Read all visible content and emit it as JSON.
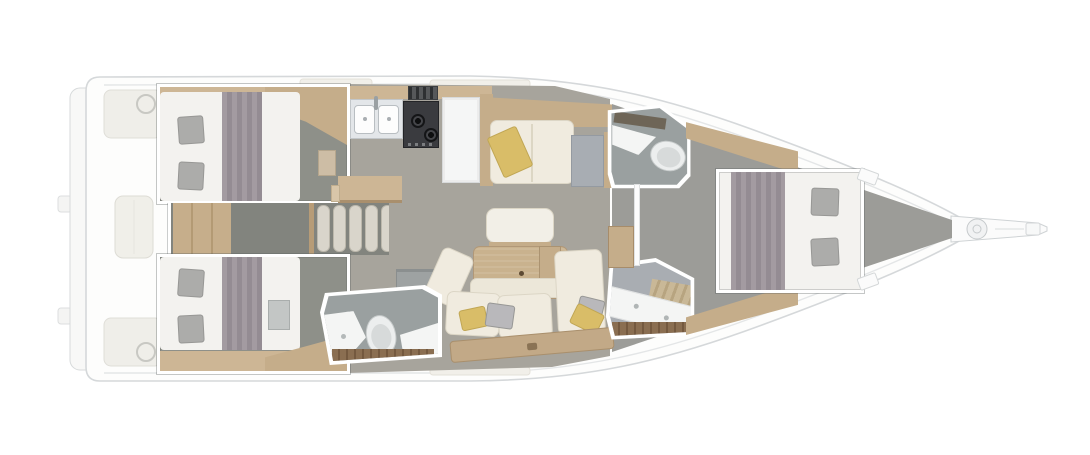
{
  "scene": {
    "type": "yacht-interior-floorplan",
    "orientation": "bow-right",
    "rooms": [
      "swim-platform",
      "aft-cockpit",
      "starboard-aft-cabin",
      "port-aft-cabin",
      "companionway-stairs",
      "galley",
      "salon",
      "starboard-head",
      "port-head",
      "forward-shower",
      "forward-cabin",
      "bowsprit"
    ],
    "furniture": [
      "double-bed-starboard-aft",
      "double-bed-port-aft",
      "double-bed-forward",
      "galley-sink",
      "galley-stove",
      "galley-oven",
      "refrigerator",
      "dining-table",
      "u-shaped-sofa",
      "white-bench",
      "starboard-settee",
      "nav-table",
      "toilet-x2",
      "shower-counter",
      "helm-wheel-x2",
      "cockpit-table",
      "anchor-windlass"
    ]
  },
  "palette": {
    "hull_line": "#d5d8da",
    "deck_white": "#fdfdfc",
    "cockpit_fill": "#efeee9",
    "floor_salon": "#a7a49c",
    "floor_cabin": "#8e9089",
    "floor_forward": "#9c9c98",
    "floor_head": "#9aa0a0",
    "floor_corridor": "#82847e",
    "wood_light": "#cdb695",
    "wood_mid": "#c5ad8a",
    "wood_dark": "#8a6e51",
    "bed_white": "#f3f2ef",
    "blanket_gray": "#9a929a",
    "pillow_gray": "#acacaa",
    "cushion_cream": "#f0ebdf",
    "pillow_yellow": "#d9bd68",
    "table_wood": "#c9b28e",
    "stairs_tread": "#d9d5cb",
    "appliance_dark": "#3a3b3f",
    "fixture_white": "#f4f5f4",
    "nav_gray": "#a8adb3",
    "panel_blue_gray": "#a9adb2"
  }
}
